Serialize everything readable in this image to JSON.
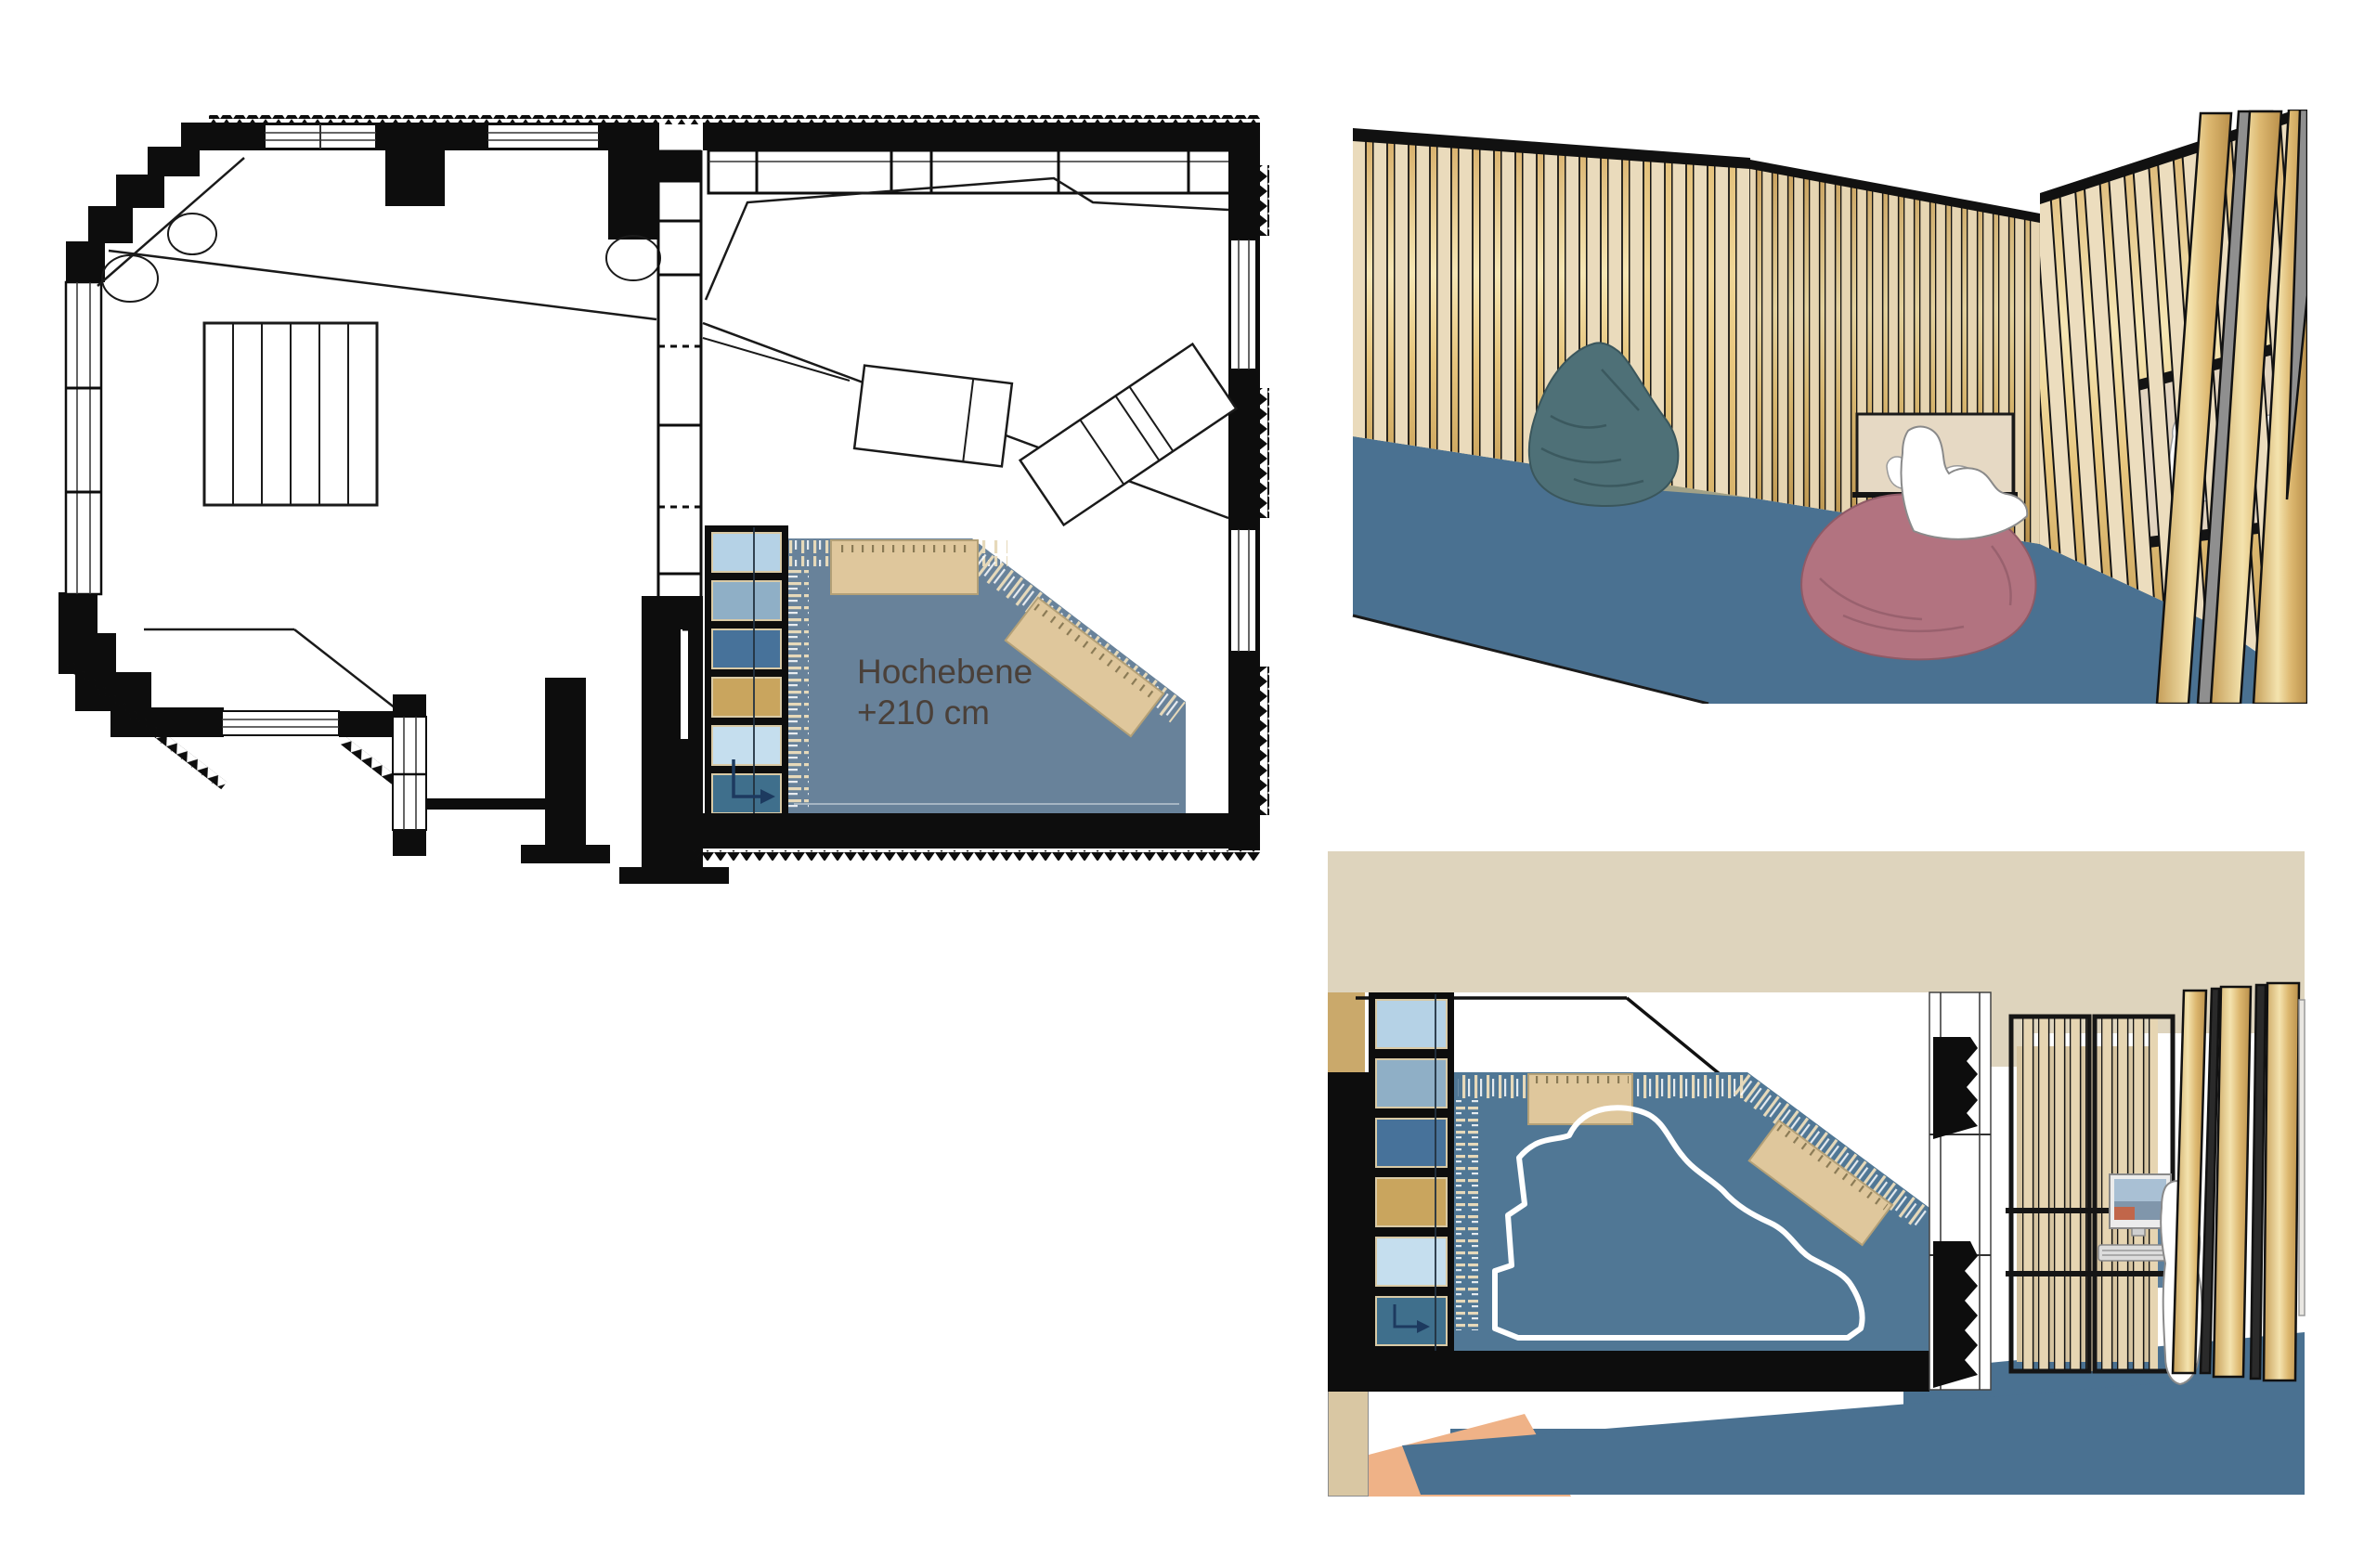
{
  "floor_plan": {
    "label_line1": "Hochebene",
    "label_line2": "+210 cm",
    "description": "ground floor plan with raised platform (Hochebene) at +210 cm, niche shelf cells, two mattresses, stair block and furniture"
  },
  "render_perspective": {
    "description": "perspective rendering of slatted wood room with bean bags, reading alcove and niche with sitting figures"
  },
  "render_section": {
    "description": "montage of platform plan detail over interior rendering with computer workstation and sitting figure"
  },
  "colors": {
    "wall-black": "#0d0d0d",
    "plan-blue": "#68829a",
    "section-blue": "#507795",
    "floor-blue": "#4a7191",
    "ceiling-beige": "#ded4bd",
    "wood-cream": "#eadbbc",
    "wood-gold-light": "#f6e7b5",
    "wood-gold-dark": "#c9a258",
    "mat-tan": "#dfc79c",
    "cell-1": "#b5d2e6",
    "cell-2": "#8fafc6",
    "cell-3": "#47729a",
    "cell-4": "#c9a55e",
    "cell-5": "#c5deee",
    "cell-6": "#3f6f8c",
    "beanbag-teal": "#4e7077",
    "beanbag-rose": "#b27380",
    "figure-white": "#ffffff",
    "label-gray": "#4a4039",
    "peach-floor": "#efb287",
    "monitor-screen-blue": "#a9c0d4",
    "monitor-screen-gray": "#8096ab",
    "monitor-screen-orange": "#c1664a"
  }
}
